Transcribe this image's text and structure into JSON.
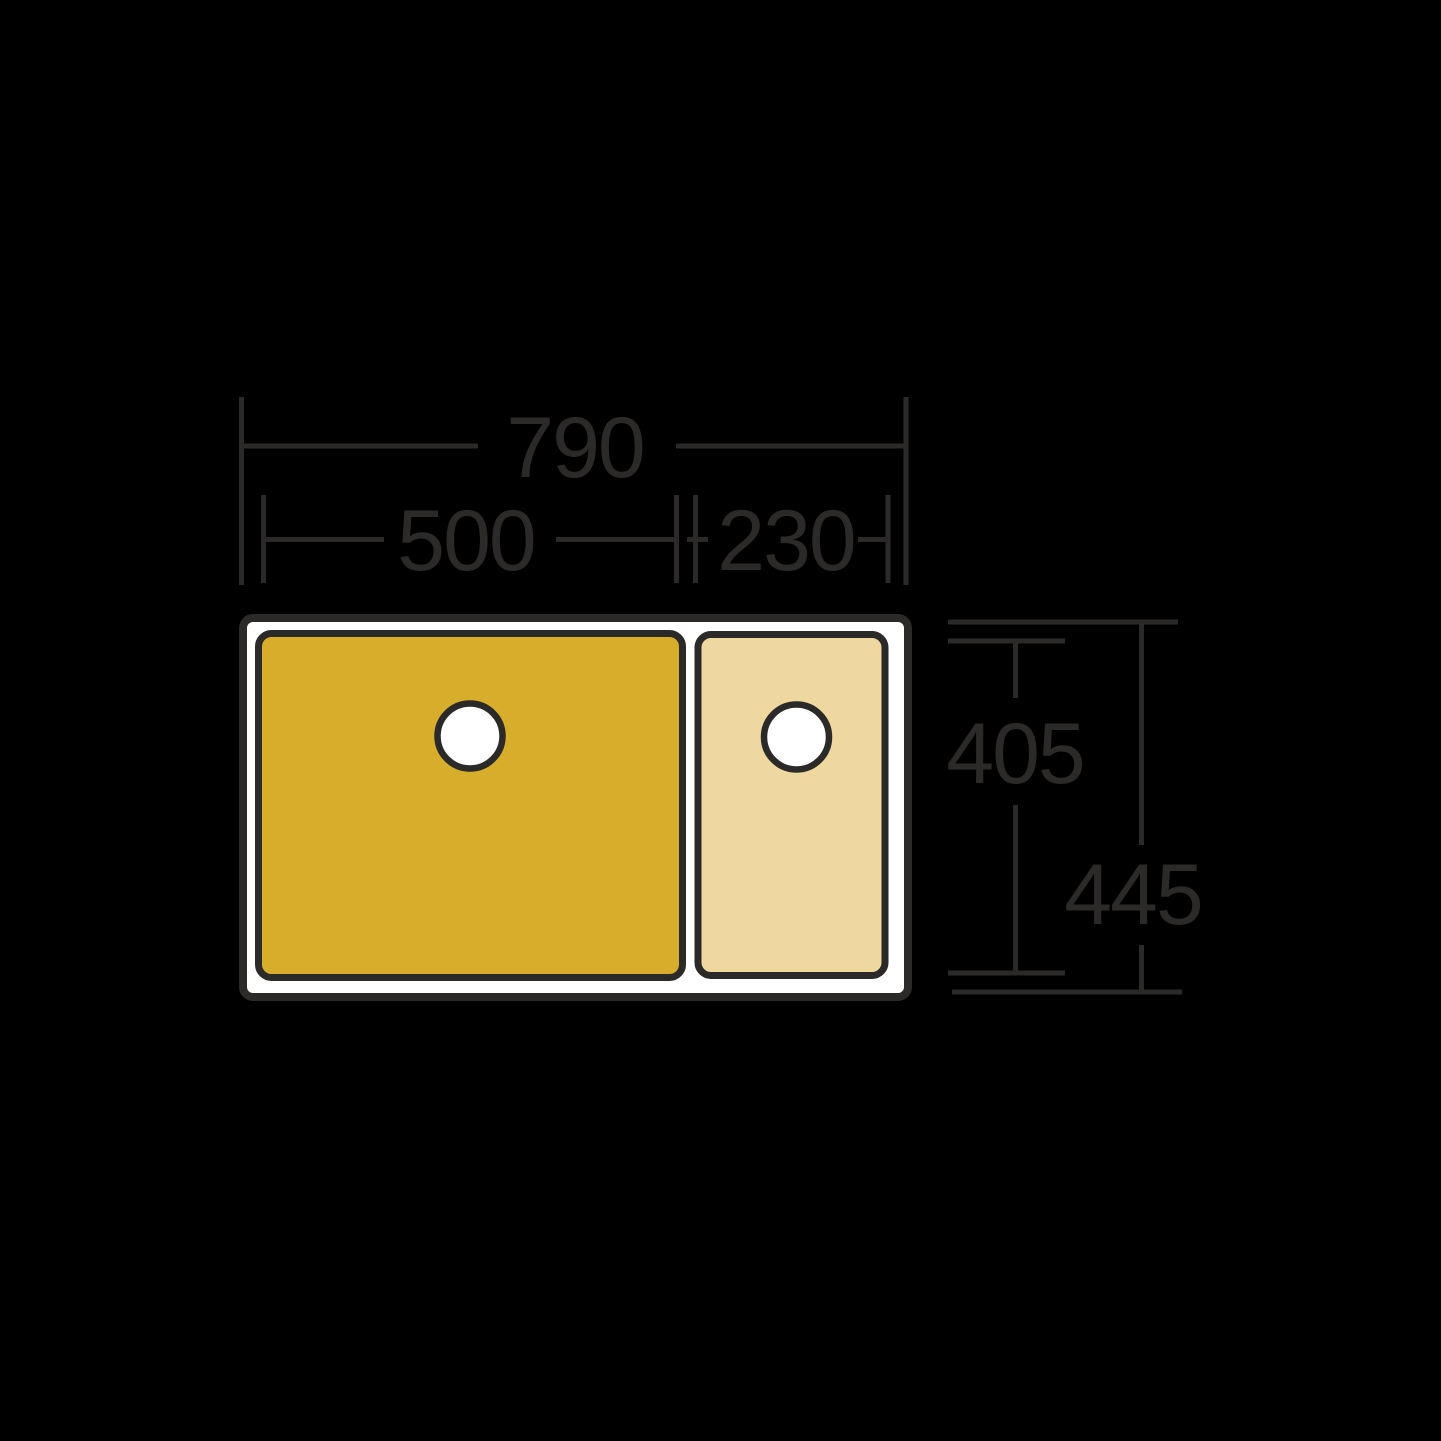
{
  "colors": {
    "bg": "#000000",
    "line": "#2b2a29",
    "sink-fill": "#ffffff",
    "bowl-main-fill": "#d7ae2b",
    "bowl-half-fill": "#eed8a0",
    "drain-fill": "#ffffff"
  },
  "dimensions": {
    "overall_width": "790",
    "main_bowl_width": "500",
    "half_bowl_width": "230",
    "bowl_front_to_back": "405",
    "overall_front_to_back": "445"
  }
}
